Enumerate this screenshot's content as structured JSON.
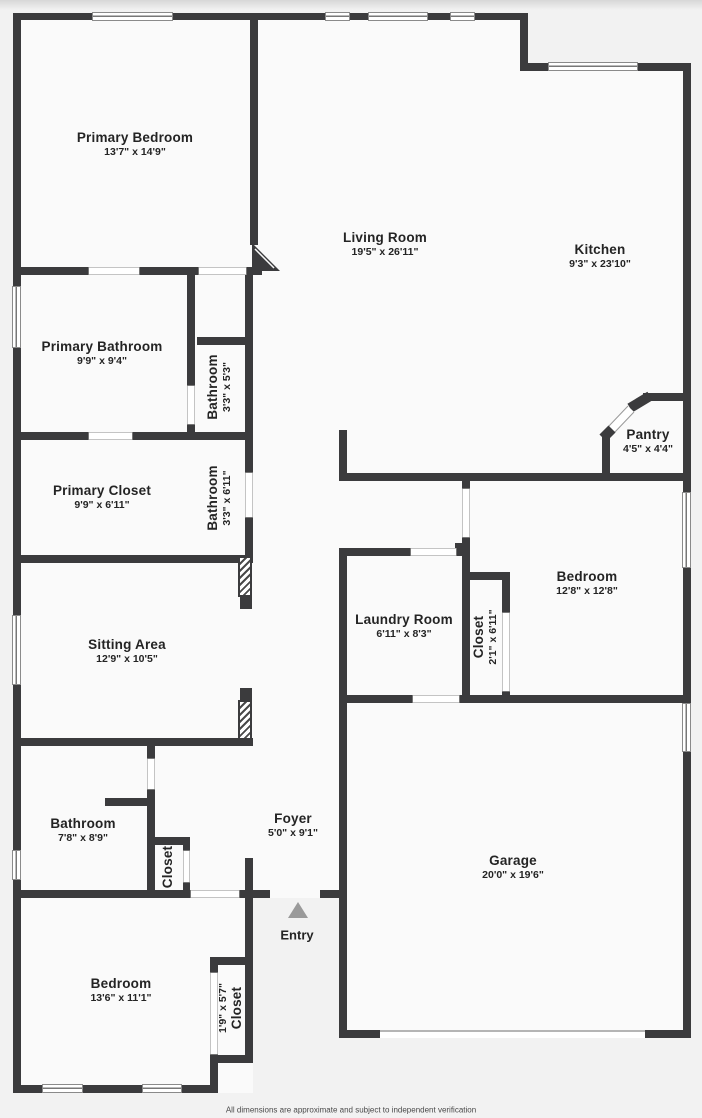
{
  "plan": {
    "title": "Floor plan",
    "disclaimer": "All dimensions are approximate and subject to independent verification",
    "entry_label": "Entry",
    "colors": {
      "wall": "#3b3b3d",
      "floor": "#fafafa",
      "background": "#f2f2f2",
      "entry_arrow": "#9a9a9a",
      "text": "#242424"
    },
    "rooms": [
      {
        "label": "Primary Bedroom",
        "dims": "13'7\" x 14'9\""
      },
      {
        "label": "Living Room",
        "dims": "19'5\" x 26'11\""
      },
      {
        "label": "Kitchen",
        "dims": "9'3\" x 23'10\""
      },
      {
        "label": "Primary Bathroom",
        "dims": "9'9\" x 9'4\""
      },
      {
        "label": "Bathroom",
        "dims": "3'3\" x 5'3\""
      },
      {
        "label": "Primary Closet",
        "dims": "9'9\" x 6'11\""
      },
      {
        "label": "Bathroom",
        "dims": "3'3\" x 6'11\""
      },
      {
        "label": "Pantry",
        "dims": "4'5\" x 4'4\""
      },
      {
        "label": "Sitting Area",
        "dims": "12'9\" x 10'5\""
      },
      {
        "label": "Laundry Room",
        "dims": "6'11\" x 8'3\""
      },
      {
        "label": "Closet",
        "dims": "2'1\" x 6'11\""
      },
      {
        "label": "Bedroom",
        "dims": "12'8\" x 12'8\""
      },
      {
        "label": "Bathroom",
        "dims": "7'8\" x 8'9\""
      },
      {
        "label": "Closet",
        "dims": ""
      },
      {
        "label": "Foyer",
        "dims": "5'0\" x 9'1\""
      },
      {
        "label": "Garage",
        "dims": "20'0\" x 19'6\""
      },
      {
        "label": "Bedroom",
        "dims": "13'6\" x 11'1\""
      },
      {
        "label": "Closet",
        "dims": "1'9\" x 5'7\""
      }
    ]
  }
}
